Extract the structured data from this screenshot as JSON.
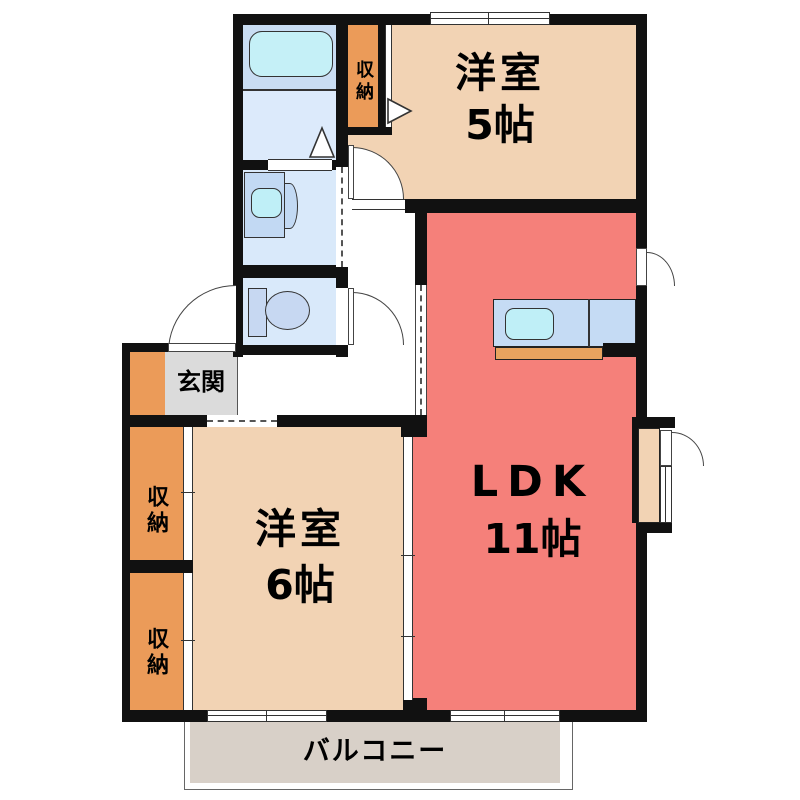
{
  "plan": {
    "type": "apartment-floor-plan",
    "rooms": {
      "western_room_5": {
        "name": "洋室",
        "size": "5帖"
      },
      "ldk": {
        "name": "LDK",
        "size": "11帖"
      },
      "western_room_6": {
        "name": "洋室",
        "size": "6帖"
      },
      "entrance": {
        "name": "玄関"
      },
      "balcony": {
        "name": "バルコニー"
      },
      "closet_bath": {
        "name": "収納"
      },
      "closet_upper": {
        "name": "収納"
      },
      "closet_lower": {
        "name": "収納"
      }
    },
    "fixtures": [
      "bathtub",
      "washbasin",
      "toilet",
      "kitchen-sink",
      "kitchen-counter"
    ],
    "colors": {
      "ldk_floor": "#F5807A",
      "western_room_floor": "#F2D3B4",
      "closet_fill": "#EB9B59",
      "entrance_floor": "#DBDBDB",
      "balcony_floor": "#D8D0C8",
      "bathroom_floor": "#C9DDF3",
      "wetroom_floor": "#D9E9FA",
      "fixture_blue": "#C2D9F3",
      "water_cyan": "#BFEFF7",
      "kitchen_counter": "#C5DBF4",
      "kitchen_counter_front": "#E8A35F",
      "wall": "#111111"
    }
  }
}
